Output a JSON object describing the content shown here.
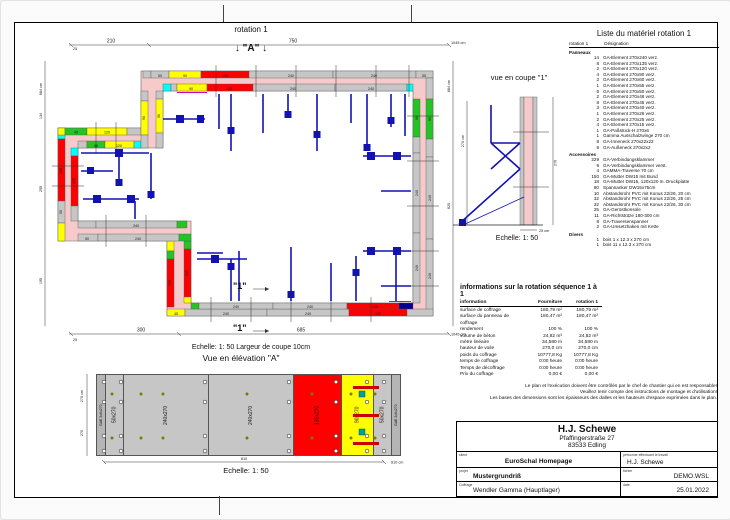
{
  "plan": {
    "title": "rotation 1",
    "marker_a": "↓ \"A\" ↓",
    "section_marker": "\"1\"",
    "caption": "Echelle: 1: 50   Largeur de coupe 10cm",
    "dims": {
      "top1": "210",
      "top2": "750",
      "top_total": "1045 cm",
      "bot1": "300",
      "bot2": "685",
      "bot_total": "1045 cm",
      "left_total": "684 cm",
      "l134": "134",
      "l255": "255",
      "l195": "195",
      "r620": "620",
      "tick25": "25"
    },
    "panels": {
      "p240": "240",
      "p135": "135",
      "p120": "120",
      "p90": "90",
      "p55": "55",
      "p50": "50",
      "p46": "46",
      "p45": "45"
    }
  },
  "coupe": {
    "title": "vue en coupe \"1\"",
    "dim_left": "270 cm",
    "dim_right": "270",
    "wall_width": "25 cm",
    "caption": "Echelle: 1: 50"
  },
  "material_list": {
    "title": "Liste du matériel  rotation 1",
    "col_qty": "rotation 1",
    "col_name": "Désignation",
    "sections": [
      {
        "name": "Panneaux",
        "items": [
          [
            "14",
            "GA-Element 270x240 verz."
          ],
          [
            "8",
            "GA-Element 270x135 verz."
          ],
          [
            "2",
            "GA-Element 270x120 verz."
          ],
          [
            "4",
            "GA-Element 270x90 verz."
          ],
          [
            "2",
            "GA-Element 270x60 verz."
          ],
          [
            "1",
            "GA-Element 270x55 verz."
          ],
          [
            "6",
            "GA-Element 270x50 verz."
          ],
          [
            "2",
            "GA-Element 270x46 verz."
          ],
          [
            "8",
            "GA-Element 270x45 verz."
          ],
          [
            "3",
            "GA-Element 270x40 verz."
          ],
          [
            "1",
            "GA-Element 270x26 verz."
          ],
          [
            "2",
            "GA-Element 270x25 verz."
          ],
          [
            "4",
            "GA-Element 270x15 verz."
          ],
          [
            "1",
            "GA-Paßstück-H 270x6"
          ],
          [
            "1",
            "Gamma Ausschalzwinge 270 cm"
          ],
          [
            "8",
            "GA-Inneneck 270x22x22"
          ],
          [
            "8",
            "GA-Außeneck 270x2x2"
          ]
        ]
      },
      {
        "name": "Accessoires",
        "items": [
          [
            "229",
            "GA-Verbindungsklammer"
          ],
          [
            "9",
            "GA-Verbindungsklammer verst."
          ],
          [
            "4",
            "GAMMA-Traverse 70 cm"
          ],
          [
            "150",
            "GA-Mutter DW15 mit Bund"
          ],
          [
            "18",
            "GA-Mutter DW15, 120x120 m. Druckplatte"
          ],
          [
            "80",
            "Spannanker DW15x75cm"
          ],
          [
            "10",
            "Abstandsrohr PVC mit Konus 22/26, 20 cm"
          ],
          [
            "32",
            "Abstandsrohr PVC mit Konus 22/26, 25 cm"
          ],
          [
            "32",
            "Abstandsrohr PVC mit Konus 22/26, 30 cm"
          ],
          [
            "25",
            "GA-Gerüstkonsole"
          ],
          [
            "11",
            "GA-Richtstütze 180-300 cm"
          ],
          [
            "8",
            "GA-Traversenspanner"
          ],
          [
            "2",
            "GA-Umsetzhaken mit Kette"
          ]
        ]
      },
      {
        "name": "Divers",
        "items": [
          [
            "1",
            "bois 1 x 12.3 x 270 cm"
          ],
          [
            "1",
            "bois 11 x 12.3 x 270 cm"
          ]
        ]
      }
    ]
  },
  "info_table": {
    "title": "informations sur la rotation  séquence 1 à 1",
    "columns": [
      "information",
      "Fourniture",
      "rotation 1"
    ],
    "rows": [
      [
        "surface de coffrage",
        "180,79 m²",
        "180,79 m²"
      ],
      [
        "surface du panneau de coffrage",
        "180,47 m²",
        "180,47 m²"
      ],
      [
        "rendement",
        "100 %",
        "100 %"
      ],
      [
        "volume de béton",
        "24,82 m³",
        "24,82 m³"
      ],
      [
        "mètre linéaire",
        "34,580 m",
        "34,580 m"
      ],
      [
        "hauteur de voile",
        "270,0 cm",
        "270,0 cm"
      ],
      [
        "poids du coffrage",
        "10777,8 Kg",
        "10777,8 Kg"
      ],
      [
        "temps de coffrage",
        "0:00 heure",
        "0:00 heure"
      ],
      [
        "Temps de décoffrage",
        "0:00 heure",
        "0:00 heure"
      ],
      [
        "Prix du coffrage",
        "0,00 €",
        "0,00 €"
      ]
    ]
  },
  "disclaimer": {
    "line1": "Le plan et l'exécution doivent être contrôlés par le chef de chantier qui en est responsable!",
    "line2": "Veuillez tenir compte des instructions de montage et d'utilisation!",
    "line3": "Les bases des dimensions sont les épaisseurs des dalles et les hauteurs d'espace exprimées dans le plan."
  },
  "title_block": {
    "company": "H.J. Schewe",
    "address1": "Pfaffingerstraße 27",
    "address2": "83533 Edling",
    "client_label": "client",
    "client": "EuroSchal Homepage",
    "worker_label": "personne effectuant le travail",
    "worker": "H.J. Schewe",
    "project_label": "projet",
    "project": "Mustergrundriß",
    "file_label": "fichier",
    "file": "DEMO.WSL",
    "coffrage_label": "Coffrage",
    "coffrage": "Wendler Gamma (Hauptlager)",
    "date_label": "date",
    "date": "25.01.2022"
  },
  "elevation": {
    "title": "Vue en élévation \"A\"",
    "caption": "Echelle: 1: 50",
    "dim_bottom": "810",
    "dim_bottom_total": "810 cm",
    "dim_left_total": "270 cm",
    "dim_left": "270",
    "panels": [
      {
        "label": "GAE 2x6x270",
        "color": "#b5b5b5",
        "w": 8
      },
      {
        "label": "50x270",
        "color": "#c6c6c6",
        "w": 17
      },
      {
        "label": "240x270",
        "color": "#c6c6c6",
        "w": 84
      },
      {
        "label": "240x270",
        "color": "#c6c6c6",
        "w": 84
      },
      {
        "label": "135x270",
        "color": "#ff0000",
        "w": 47
      },
      {
        "label": "90x270",
        "color": "#ffff00",
        "w": 31
      },
      {
        "label": "50x270",
        "color": "#c6c6c6",
        "w": 17
      },
      {
        "label": "GAE 2x6x270",
        "color": "#b5b5b5",
        "w": 8
      }
    ]
  }
}
